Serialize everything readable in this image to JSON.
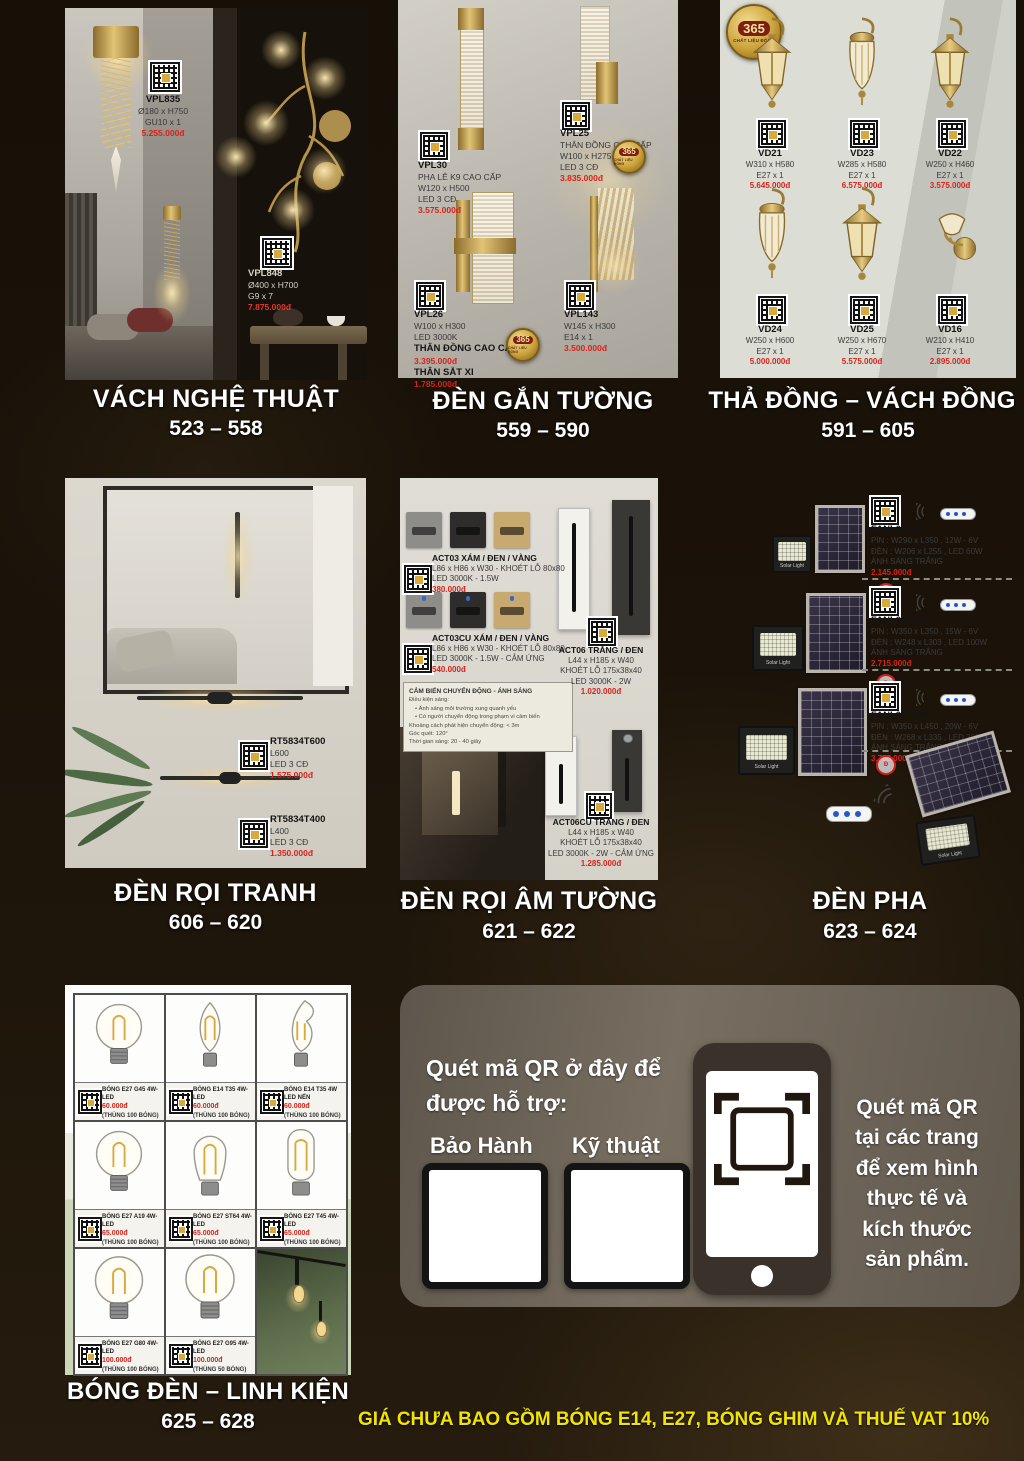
{
  "colors": {
    "price_red": "#d8231a",
    "footer_yellow": "#f2e400",
    "badge_gold": "#c99d35"
  },
  "footer": {
    "disclaimer": "GIÁ CHƯA BAO GỒM BÓNG E14, E27, BÓNG GHIM VÀ THUẾ VAT 10%"
  },
  "badge": {
    "number": "365",
    "label": "CHẤT LIỆU ĐỒNG"
  },
  "sections": {
    "art_wall": {
      "title": "VÁCH NGHỆ THUẬT",
      "range": "523 – 558",
      "products": [
        {
          "code": "VPL835",
          "d1": "Ø180 x H750",
          "d2": "GU10 x 1",
          "price": "5.255.000đ"
        },
        {
          "code": "VPL848",
          "d1": "Ø400 x H700",
          "d2": "G9 x 7",
          "price": "7.875.000đ"
        }
      ]
    },
    "wall_lamps": {
      "title": "ĐÈN GẮN TƯỜNG",
      "range": "559 – 590",
      "products": [
        {
          "code": "VPL30",
          "l1": "PHA LÊ K9 CAO CẤP",
          "l2": "W120 x H500",
          "l3": "LED 3 CĐ",
          "price": "3.575.000đ"
        },
        {
          "code": "VPL25",
          "l1": "THÂN ĐỒNG CAO CẤP",
          "l2": "W100 x H275",
          "l3": "LED 3 CĐ",
          "price": "3.835.000đ"
        },
        {
          "code": "VPL26",
          "l1": "W100 x H300",
          "l2": "LED 3000K",
          "v1_label": "THÂN ĐỒNG CAO CẤP",
          "v1_price": "3.395.000đ",
          "v2_label": "THÂN SẮT XI",
          "v2_price": "1.785.000đ"
        },
        {
          "code": "VPL143",
          "l1": "W145 x H300",
          "l2": "E14 x 1",
          "price": "3.500.000đ"
        }
      ]
    },
    "copper_lamps": {
      "title": "THẢ ĐỒNG – VÁCH ĐỒNG",
      "range": "591 – 605",
      "products": [
        {
          "code": "VD21",
          "dim": "W310 x H580",
          "socket": "E27 x 1",
          "price": "5.645.000đ"
        },
        {
          "code": "VD23",
          "dim": "W285 x H580",
          "socket": "E27 x 1",
          "price": "6.575.000đ"
        },
        {
          "code": "VD22",
          "dim": "W250 x H460",
          "socket": "E27 x 1",
          "price": "3.575.000đ"
        },
        {
          "code": "VD24",
          "dim": "W250 x H600",
          "socket": "E27 x 1",
          "price": "5.000.000đ"
        },
        {
          "code": "VD25",
          "dim": "W250 x H670",
          "socket": "E27 x 1",
          "price": "5.575.000đ"
        },
        {
          "code": "VD16",
          "dim": "W210 x H410",
          "socket": "E27 x 1",
          "price": "2.895.000đ"
        }
      ]
    },
    "picture_lights": {
      "title": "ĐÈN RỌI TRANH",
      "range": "606 – 620",
      "products": [
        {
          "code": "RT5834T600",
          "l1": "L600",
          "l2": "LED 3 CĐ",
          "price": "1.575.000đ"
        },
        {
          "code": "RT5834T400",
          "l1": "L400",
          "l2": "LED 3 CĐ",
          "price": "1.350.000đ"
        }
      ]
    },
    "recessed_lights": {
      "title": "ĐÈN RỌI ÂM TƯỜNG",
      "range": "621 – 622",
      "products": [
        {
          "code": "ACT03 XÁM / ĐEN / VÀNG",
          "l1": "L86 x H86 x W30 - KHOÉT LỖ 80x80",
          "l2": "LED 3000K - 1.5W",
          "price": "380.000đ"
        },
        {
          "code": "ACT03CU XÁM / ĐEN / VÀNG",
          "l1": "L86 x H86 x W30 - KHOÉT LỖ 80x80",
          "l2": "LED 3000K - 1.5W - CẢM ỨNG",
          "price": "540.000đ"
        },
        {
          "code": "ACT06 TRẮNG / ĐEN",
          "l1": "L44 x H185 x W40",
          "l2": "KHOÉT LỖ 175x38x40",
          "l3": "LED 3000K - 2W",
          "price": "1.020.000đ"
        },
        {
          "code": "ACT06CU TRẮNG / ĐEN",
          "l1": "L44 x H185 x W40",
          "l2": "KHOÉT LỖ 175x38x40",
          "l3": "LED 3000K - 2W - CẢM ỨNG",
          "price": "1.285.000đ"
        }
      ],
      "sensor_note": {
        "title": "CẢM BIẾN CHUYỂN ĐỘNG - ÁNH SÁNG",
        "lines": [
          "Điều kiện sáng:",
          "• Ánh sáng môi trường xung quanh yếu",
          "• Có người chuyển động trong phạm vi cảm biến",
          "Khoảng cách phát hiện chuyển động: < 3m",
          "Góc quét: 120°",
          "Thời gian sáng: 20 - 40 giây"
        ]
      }
    },
    "flood_lights": {
      "title": "ĐÈN PHA",
      "range": "623 – 624",
      "device_label": "Solar Light",
      "products": [
        {
          "code": "FANL03T60",
          "l1": "PIN : W290 x L350 , 12W - 6V",
          "l2": "ĐÈN : W206 x L255 , LED 60W",
          "l3": "ÁNH SÁNG TRẮNG",
          "price": "2.145.000đ"
        },
        {
          "code": "FANL03T100",
          "l1": "PIN : W350 x L350 , 15W - 6V",
          "l2": "ĐÈN : W248 x L303 , LED 100W",
          "l3": "ÁNH SÁNG TRẮNG",
          "price": "2.715.000đ"
        },
        {
          "code": "FANL03T200",
          "l1": "PIN : W350 x L450 , 20W - 6V",
          "l2": "ĐÈN : W268 x L335 , LED 200W",
          "l3": "ÁNH SÁNG TRẮNG",
          "price": "3.755.000đ"
        }
      ]
    },
    "bulbs": {
      "title": "BÓNG ĐÈN – LINH KIỆN",
      "range": "625 – 628",
      "items": [
        {
          "name": "BÓNG E27 G45 4W-LED",
          "price": "60.000đ",
          "pack": "(THÙNG 100 BÓNG)"
        },
        {
          "name": "BÓNG E14 T35 4W-LED",
          "price": "60.000đ",
          "pack": "(THÙNG 100 BÓNG)"
        },
        {
          "name": "BÓNG E14 T35 4W LED NẾN",
          "price": "60.000đ",
          "pack": "(THÙNG 100 BÓNG)"
        },
        {
          "name": "BÓNG E27 A19 4W-LED",
          "price": "65.000đ",
          "pack": "(THÙNG 100 BÓNG)"
        },
        {
          "name": "BÓNG E27 ST64 4W-LED",
          "price": "65.000đ",
          "pack": "(THÙNG 100 BÓNG)"
        },
        {
          "name": "BÓNG E27 T45 4W-LED",
          "price": "65.000đ",
          "pack": "(THÙNG 100 BÓNG)"
        },
        {
          "name": "BÓNG E27 G80 4W-LED",
          "price": "100.000đ",
          "pack": "(THÙNG 100 BÓNG)"
        },
        {
          "name": "BÓNG E27 G95 4W-LED",
          "price": "100.000đ",
          "pack": "(THÙNG 50 BÓNG)"
        }
      ]
    },
    "qr_info": {
      "heading_line1": "Quét mã QR ở đây để",
      "heading_line2": "được hỗ trợ:",
      "warranty": "Bảo Hành",
      "technical": "Kỹ thuật",
      "side_lines": [
        "Quét mã QR",
        "tại các trang",
        "để xem hình",
        "thực tế và",
        "kích thước",
        "sản phẩm."
      ]
    }
  }
}
